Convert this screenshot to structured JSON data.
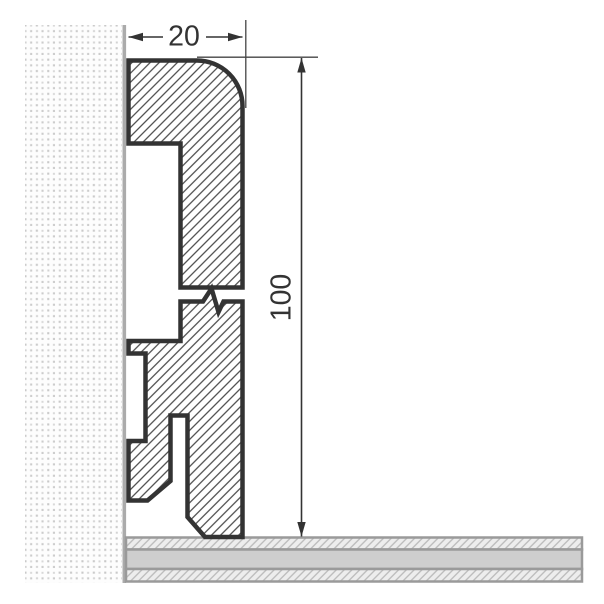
{
  "diagram": {
    "name": "skirting-board-profile-cross-section",
    "dim_width": {
      "label": "20"
    },
    "dim_height": {
      "label": "100"
    },
    "colors": {
      "outline": "#333333",
      "hatch_line": "#3c3c3c",
      "dimension": "#333333",
      "wall_edge": "#ababab",
      "wall_dot": "#cdcdcd",
      "floor_border": "#9a9a9a",
      "floor_solid": "#cecece",
      "floor_hatch_bg": "#ededed"
    }
  }
}
